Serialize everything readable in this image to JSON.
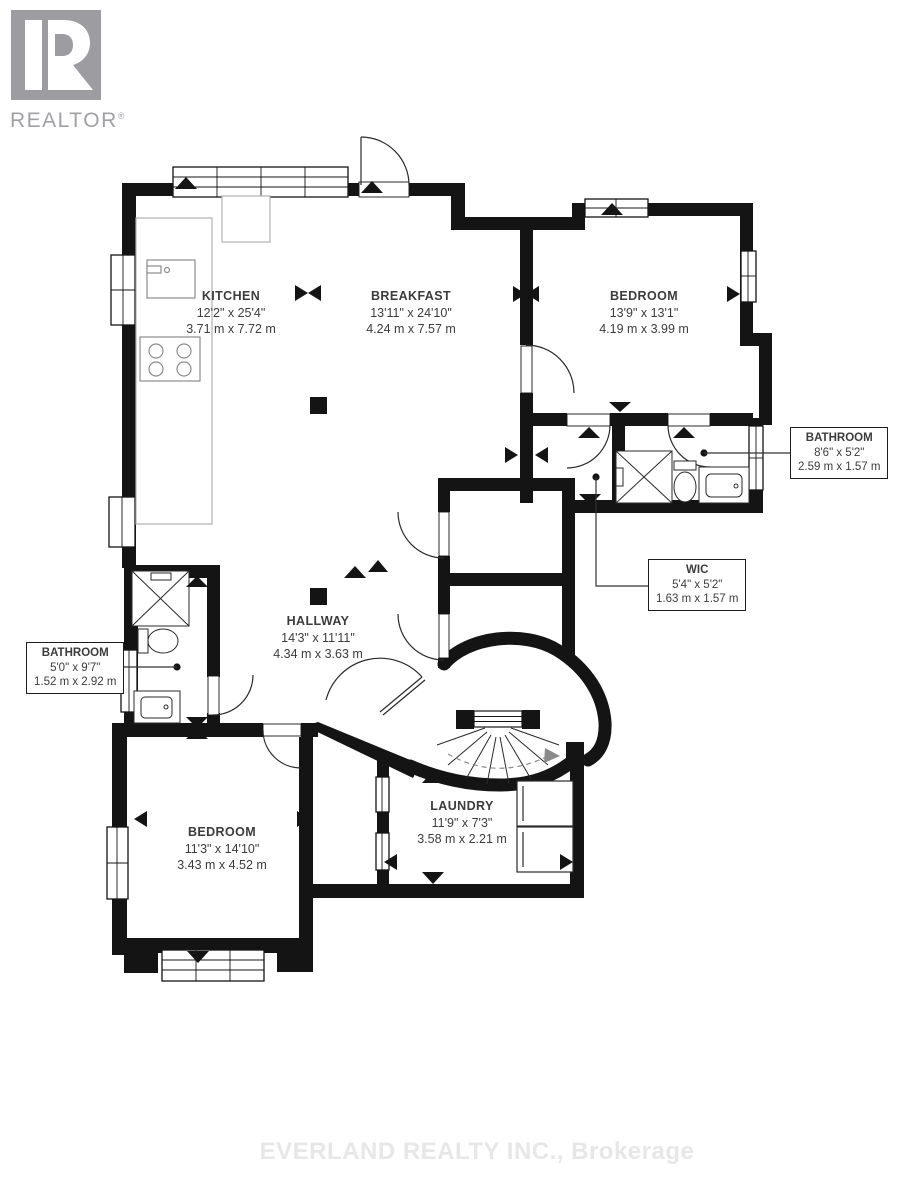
{
  "logo": {
    "name": "REALTOR",
    "reg": "®"
  },
  "watermark": "EVERLAND REALTY INC., Brokerage",
  "rooms": [
    {
      "key": "kitchen",
      "name": "KITCHEN",
      "imperial": "12'2\" x 25'4\"",
      "metric": "3.71 m x 7.72 m"
    },
    {
      "key": "breakfast",
      "name": "BREAKFAST",
      "imperial": "13'11\" x 24'10\"",
      "metric": "4.24 m x 7.57 m"
    },
    {
      "key": "bedroom-upper",
      "name": "BEDROOM",
      "imperial": "13'9\" x 13'1\"",
      "metric": "4.19 m x 3.99 m"
    },
    {
      "key": "bathroom-right",
      "name": "BATHROOM",
      "imperial": "8'6\" x 5'2\"",
      "metric": "2.59 m x 1.57 m"
    },
    {
      "key": "wic",
      "name": "WIC",
      "imperial": "5'4\" x 5'2\"",
      "metric": "1.63 m x 1.57 m"
    },
    {
      "key": "hallway",
      "name": "HALLWAY",
      "imperial": "14'3\" x 11'11\"",
      "metric": "4.34 m x 3.63 m"
    },
    {
      "key": "bathroom-left",
      "name": "BATHROOM",
      "imperial": "5'0\" x 9'7\"",
      "metric": "1.52 m x 2.92 m"
    },
    {
      "key": "bedroom-lower",
      "name": "BEDROOM",
      "imperial": "11'3\" x 14'10\"",
      "metric": "3.43 m x 4.52 m"
    },
    {
      "key": "laundry",
      "name": "LAUNDRY",
      "imperial": "11'9\" x 7'3\"",
      "metric": "3.58 m x 2.21 m"
    }
  ],
  "colors": {
    "wall": "#141414",
    "label_text": "#3c3c3c",
    "watermark": "#e7e7e7",
    "logo_gray": "#a0a0a5"
  }
}
